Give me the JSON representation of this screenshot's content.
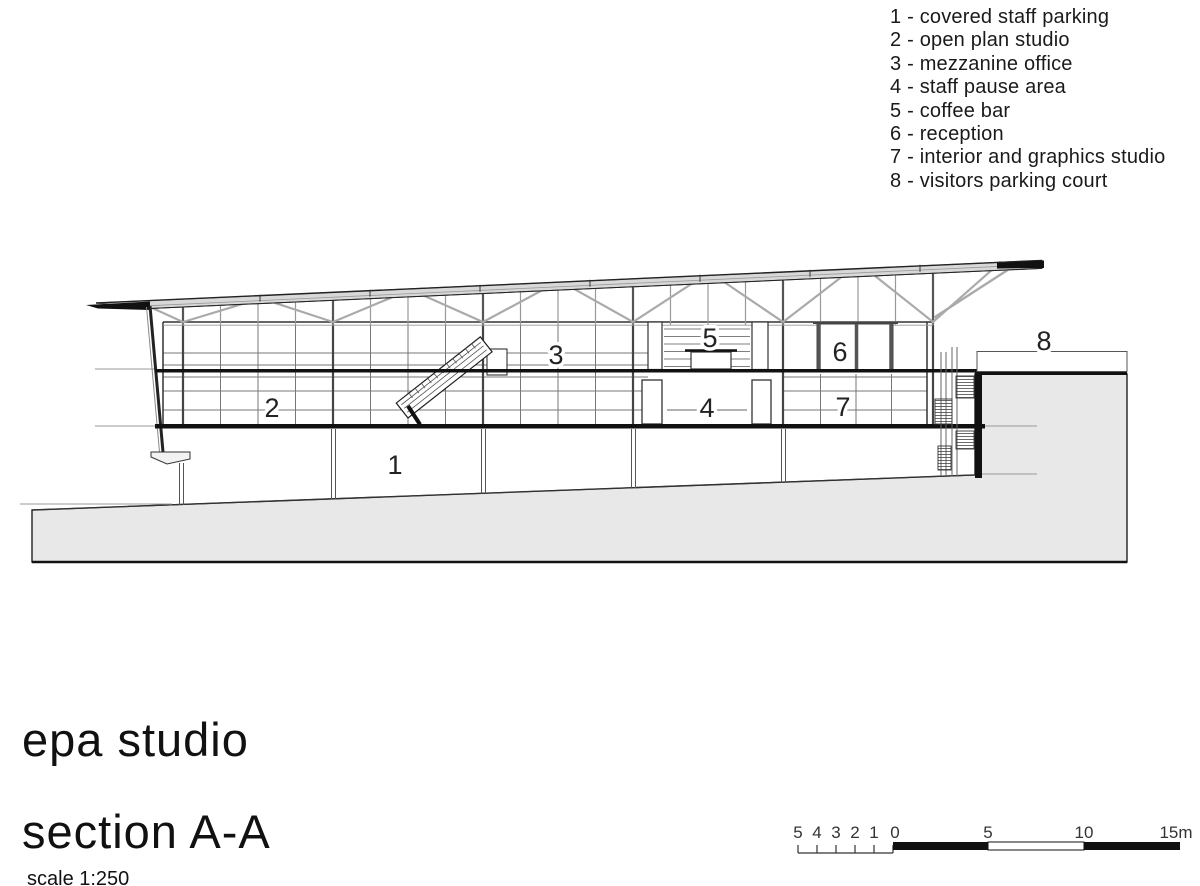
{
  "legend": {
    "items": [
      "1 - covered staff parking",
      "2 - open plan studio",
      "3 - mezzanine office",
      "4 - staff pause area",
      "5 - coffee bar",
      "6 - reception",
      "7 - interior and graphics studio",
      "8 - visitors parking court"
    ]
  },
  "section_labels": {
    "n1": "1",
    "n2": "2",
    "n3": "3",
    "n4": "4",
    "n5": "5",
    "n6": "6",
    "n7": "7",
    "n8": "8"
  },
  "title_block": {
    "project": "epa studio",
    "drawing": "section A-A",
    "scale_note": "scale 1:250"
  },
  "scale_bar": {
    "minor": [
      "5",
      "4",
      "3",
      "2",
      "1"
    ],
    "zero": "0",
    "mid": "5",
    "mid2": "10",
    "end": "15m"
  },
  "colors": {
    "ink": "#1a1a1a",
    "grid_gray": "#777777",
    "truss_gray": "#aaaaaa",
    "terrain_fill": "#e8e8e8",
    "roof_fill": "#d8d8d8"
  }
}
